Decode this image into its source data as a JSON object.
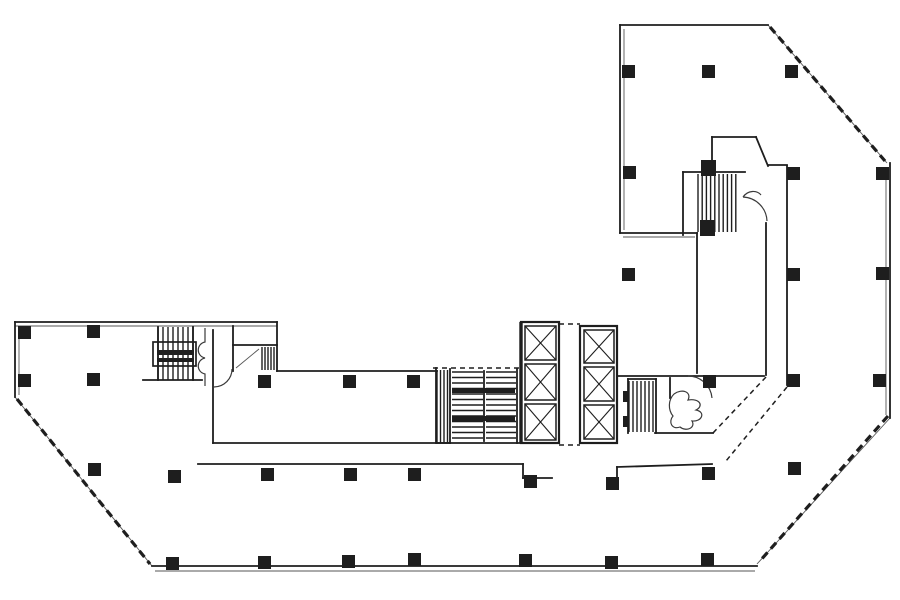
{
  "drawing": {
    "title": "office-floor-plan-scan",
    "canvas": {
      "width": 900,
      "height": 600
    },
    "colors": {
      "background": "#ffffff",
      "ink": "#1e1e1e",
      "soft_ink": "#3a3a3a"
    },
    "walls_medium": [
      [
        15,
        322,
        277,
        322
      ],
      [
        15,
        322,
        15,
        397
      ],
      [
        277,
        322,
        277,
        371
      ],
      [
        277,
        371,
        437,
        371
      ],
      [
        152,
        566,
        757,
        566
      ],
      [
        890,
        163,
        890,
        418
      ],
      [
        620,
        25,
        768,
        25
      ],
      [
        620,
        25,
        620,
        233
      ],
      [
        620,
        233,
        697,
        233
      ],
      [
        697,
        233,
        697,
        373
      ],
      [
        617,
        376,
        764,
        376
      ],
      [
        766,
        223,
        766,
        375
      ],
      [
        787,
        166,
        787,
        385
      ],
      [
        768,
        165,
        787,
        165
      ],
      [
        213,
        330,
        213,
        443
      ],
      [
        213,
        443,
        450,
        443
      ],
      [
        198,
        464,
        523,
        464
      ],
      [
        523,
        464,
        523,
        478
      ],
      [
        523,
        478,
        552,
        478
      ],
      [
        617,
        467,
        617,
        481
      ],
      [
        617,
        467,
        712,
        464
      ],
      [
        143,
        380,
        202,
        380
      ],
      [
        233,
        345,
        277,
        345
      ],
      [
        233,
        326,
        233,
        371
      ],
      [
        158,
        327,
        158,
        380
      ],
      [
        193,
        327,
        193,
        380
      ],
      [
        656,
        379,
        656,
        433
      ],
      [
        628,
        379,
        656,
        379
      ],
      [
        628,
        379,
        628,
        433
      ],
      [
        655,
        433,
        713,
        433
      ],
      [
        670,
        378,
        670,
        398
      ],
      [
        683,
        172,
        683,
        235
      ],
      [
        683,
        172,
        745,
        172
      ],
      [
        712,
        137,
        712,
        172
      ],
      [
        712,
        137,
        756,
        137
      ],
      [
        756,
        137,
        768,
        166
      ],
      [
        436,
        368,
        436,
        443
      ],
      [
        450,
        369,
        450,
        443
      ],
      [
        517,
        369,
        517,
        443
      ],
      [
        484,
        371,
        484,
        441
      ],
      [
        437,
        443,
        521,
        443
      ]
    ],
    "walls_thick": [
      [
        521,
        322,
        521,
        443
      ]
    ],
    "walls_thin": [
      [
        15,
        326,
        277,
        326
      ],
      [
        19,
        326,
        19,
        395
      ],
      [
        155,
        571,
        755,
        571
      ],
      [
        886,
        167,
        886,
        415
      ],
      [
        624,
        29,
        624,
        230
      ],
      [
        623,
        237,
        695,
        237
      ],
      [
        768,
        25,
        887,
        163
      ],
      [
        890,
        418,
        757,
        564
      ],
      [
        15,
        397,
        152,
        566
      ],
      [
        236,
        368,
        259,
        349
      ]
    ],
    "dash_heavy": [
      [
        770,
        27,
        885,
        161
      ],
      [
        888,
        416,
        759,
        562
      ],
      [
        17,
        399,
        150,
        564
      ]
    ],
    "dash_light": [
      [
        433,
        368,
        519,
        368
      ],
      [
        559,
        324,
        580,
        324
      ],
      [
        559,
        445,
        580,
        445
      ],
      [
        766,
        377,
        713,
        433
      ],
      [
        787,
        387,
        726,
        461
      ]
    ],
    "outline_rects": [
      [
        153,
        342,
        43,
        24,
        1.7
      ],
      [
        521,
        322,
        38,
        121,
        2.2
      ],
      [
        580,
        326,
        37,
        117,
        2.2
      ]
    ],
    "elevator_shafts": [
      [
        525,
        326,
        31,
        34
      ],
      [
        525,
        364,
        31,
        36
      ],
      [
        525,
        404,
        31,
        36
      ],
      [
        584,
        330,
        30,
        33
      ],
      [
        584,
        367,
        30,
        34
      ],
      [
        584,
        405,
        30,
        34
      ]
    ],
    "stair_hatches": [
      {
        "x": 158,
        "y": 327,
        "w": 35,
        "h": 53,
        "step": 5,
        "o": "v"
      },
      {
        "x": 262,
        "y": 347,
        "w": 13,
        "h": 23,
        "step": 3,
        "o": "v"
      },
      {
        "x": 437,
        "y": 370,
        "w": 13,
        "h": 73,
        "step": 3.5,
        "o": "v"
      },
      {
        "x": 452,
        "y": 372,
        "w": 31,
        "h": 69,
        "step": 5.5,
        "o": "h"
      },
      {
        "x": 486,
        "y": 372,
        "w": 30,
        "h": 69,
        "step": 5.5,
        "o": "h"
      },
      {
        "x": 629,
        "y": 381,
        "w": 26,
        "h": 51,
        "step": 4,
        "o": "v"
      },
      {
        "x": 698,
        "y": 174,
        "w": 42,
        "h": 58,
        "step": 4.2,
        "o": "v"
      }
    ],
    "solid_bars": [
      [
        452,
        388,
        63,
        5
      ],
      [
        452,
        416,
        63,
        5
      ],
      [
        157,
        350,
        37,
        5
      ],
      [
        157,
        358,
        37,
        4
      ],
      [
        623,
        391,
        6,
        11
      ],
      [
        623,
        416,
        6,
        11
      ]
    ],
    "fixture_paths": [
      "M 205,328 L 205,342 C 196,344 196,356 205,358 C 196,360 196,372 205,374 L 205,386",
      "M 232,369 A 18 18 0 0 1 214,387",
      "M 674,394 C 682,388 692,392 688,400 C 700,398 704,406 696,410 C 706,412 702,422 692,421 C 696,428 686,432 680,427 C 672,430 668,422 673,416 C 668,410 668,400 674,394",
      "M 712,398 A 24 24 0 0 0 688,376",
      "M 767,221 A 25 25 0 0 0 743,197",
      "M 743,197 C 748,190 757,190 761,195"
    ],
    "columns": [
      [
        622,
        65
      ],
      [
        702,
        65
      ],
      [
        785,
        65
      ],
      [
        623,
        166
      ],
      [
        787,
        167
      ],
      [
        876,
        167
      ],
      [
        622,
        268
      ],
      [
        787,
        268
      ],
      [
        876,
        267
      ],
      [
        703,
        375
      ],
      [
        787,
        374
      ],
      [
        873,
        374
      ],
      [
        788,
        462
      ],
      [
        18,
        326
      ],
      [
        87,
        325
      ],
      [
        18,
        374
      ],
      [
        87,
        373
      ],
      [
        258,
        375
      ],
      [
        343,
        375
      ],
      [
        407,
        375
      ],
      [
        88,
        463
      ],
      [
        168,
        470
      ],
      [
        261,
        468
      ],
      [
        344,
        468
      ],
      [
        408,
        468
      ],
      [
        524,
        475
      ],
      [
        606,
        477
      ],
      [
        702,
        467
      ],
      [
        166,
        557
      ],
      [
        258,
        556
      ],
      [
        342,
        555
      ],
      [
        408,
        553
      ],
      [
        519,
        554
      ],
      [
        605,
        556
      ],
      [
        701,
        553
      ],
      [
        701,
        160,
        15,
        16
      ],
      [
        700,
        220,
        15,
        16
      ]
    ]
  }
}
